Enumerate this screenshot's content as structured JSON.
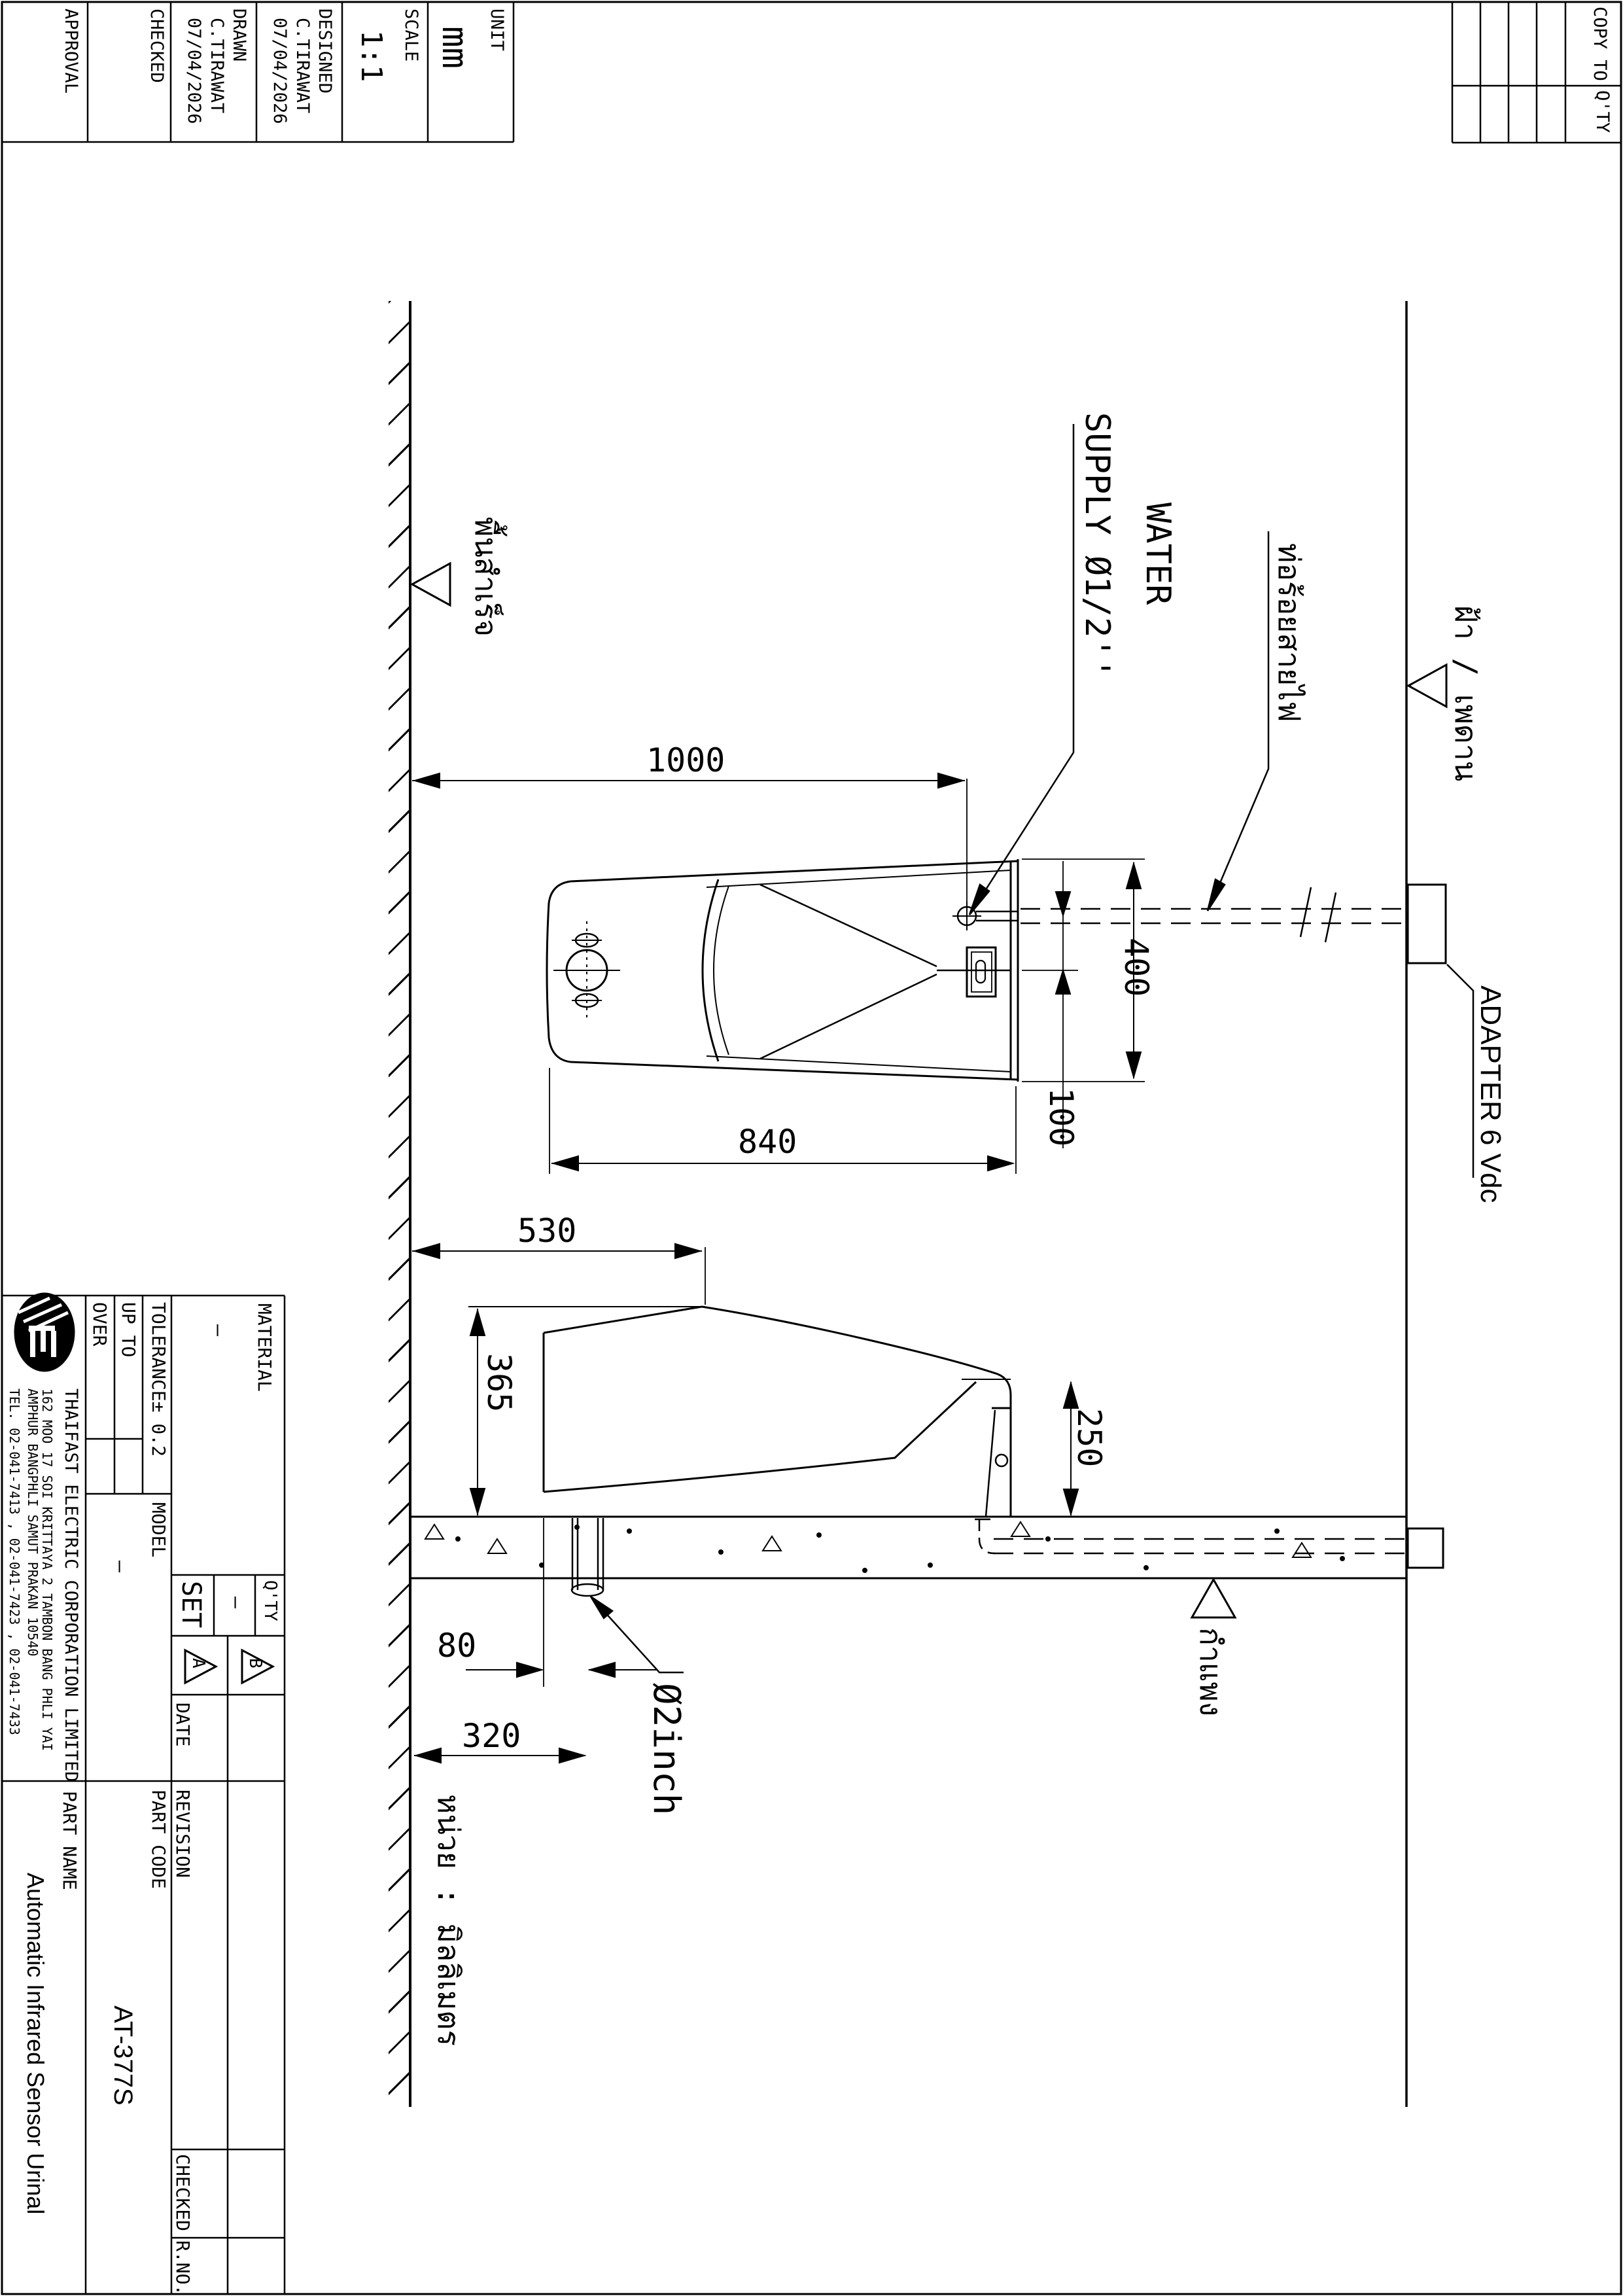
{
  "top_block": {
    "columns": [
      {
        "label": "APPROVAL",
        "name": "",
        "date": ""
      },
      {
        "label": "CHECKED",
        "name": "",
        "date": ""
      },
      {
        "label": "DRAWN",
        "name": "C.TIRAWAT",
        "date": "07/04/2026"
      },
      {
        "label": "DESIGNED",
        "name": "C.TIRAWAT",
        "date": "07/04/2026"
      },
      {
        "label": "SCALE",
        "value": "1:1"
      },
      {
        "label": "UNIT",
        "value": "mm"
      }
    ]
  },
  "copy_block": {
    "copy_to_label": "COPY TO",
    "qty_label": "Q'TY"
  },
  "drawing": {
    "dim_1000": "1000",
    "dim_840": "840",
    "dim_400": "400",
    "dim_100": "100",
    "dim_530": "530",
    "dim_365": "365",
    "dim_250": "250",
    "dim_80": "80",
    "dim_320": "320",
    "drain_label": "Ø2inch",
    "water_supply_line1": "WATER",
    "water_supply_line2": "SUPPLY Ø1/2''",
    "adapter_label": "ADAPTER 6 Vdc",
    "thai_floor": "พื้นสำเร็จ",
    "thai_ceiling": "ฝ้า / เพดาน",
    "thai_conduit": "ท่อร้อยสายไฟ",
    "thai_wall": "กำแพง",
    "thai_unit_note": "หน่วย : มิลลิเมตร"
  },
  "title_block": {
    "company_name": "THAIFAST ELECTRIC CORPORATION LIMITED",
    "address_line1": "162 MOO 17 SOI KRITTAYA 2 TAMBON BANG PHLI YAI",
    "address_line2": "AMPHUR BANGPHLI SAMUT PRAKAN 10540",
    "address_line3": "TEL. 02-041-7413 , 02-041-7423 , 02-041-7433",
    "material_label": "MATERIAL",
    "material_value": "—",
    "tolerance_label": "TOLERANCE± 0.2",
    "up_to_label": "UP TO",
    "over_label": "OVER",
    "model_label": "MODEL",
    "model_value": "—",
    "set_label": "SET",
    "set_value": "—",
    "qty_label": "Q'TY",
    "rev_a": "A",
    "rev_b": "B",
    "date_label": "DATE",
    "revision_label": "REVISION",
    "part_code_label": "PART CODE",
    "part_code": "AT-377S",
    "part_name_label": "PART NAME",
    "part_name": "Automatic Infrared Sensor Urinal",
    "checked_label": "CHECKED",
    "rno_label": "R.NO."
  },
  "colors": {
    "line": "#000000",
    "background": "#ffffff"
  }
}
